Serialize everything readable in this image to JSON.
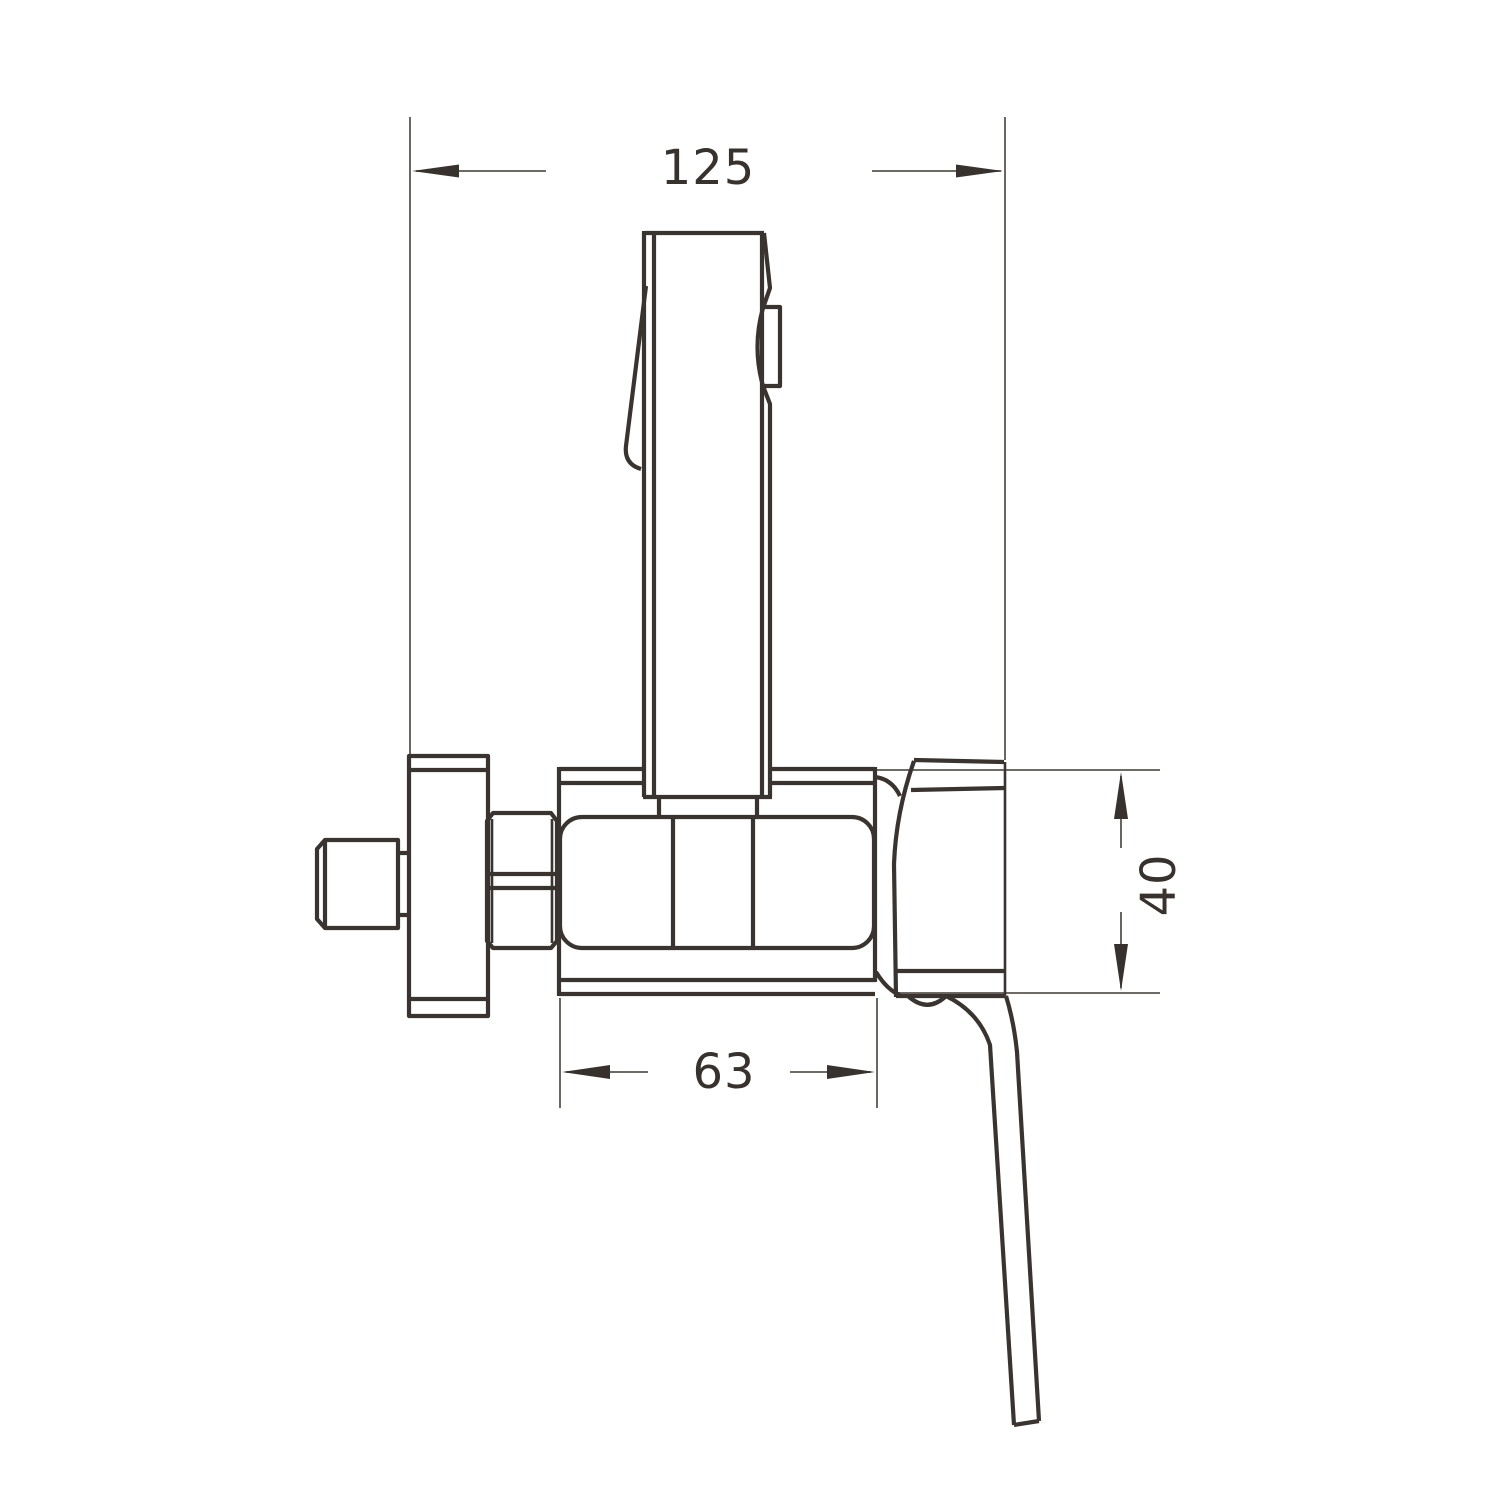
{
  "drawing": {
    "dimension_labels": {
      "overall_width": "125",
      "body_width": "63",
      "body_height": "40"
    },
    "colors": {
      "background": "#ffffff",
      "object_lines": "#3a3430",
      "dimension_lines": "#5a5550",
      "arrow_fill": "#38322e",
      "text": "#38322e"
    }
  }
}
